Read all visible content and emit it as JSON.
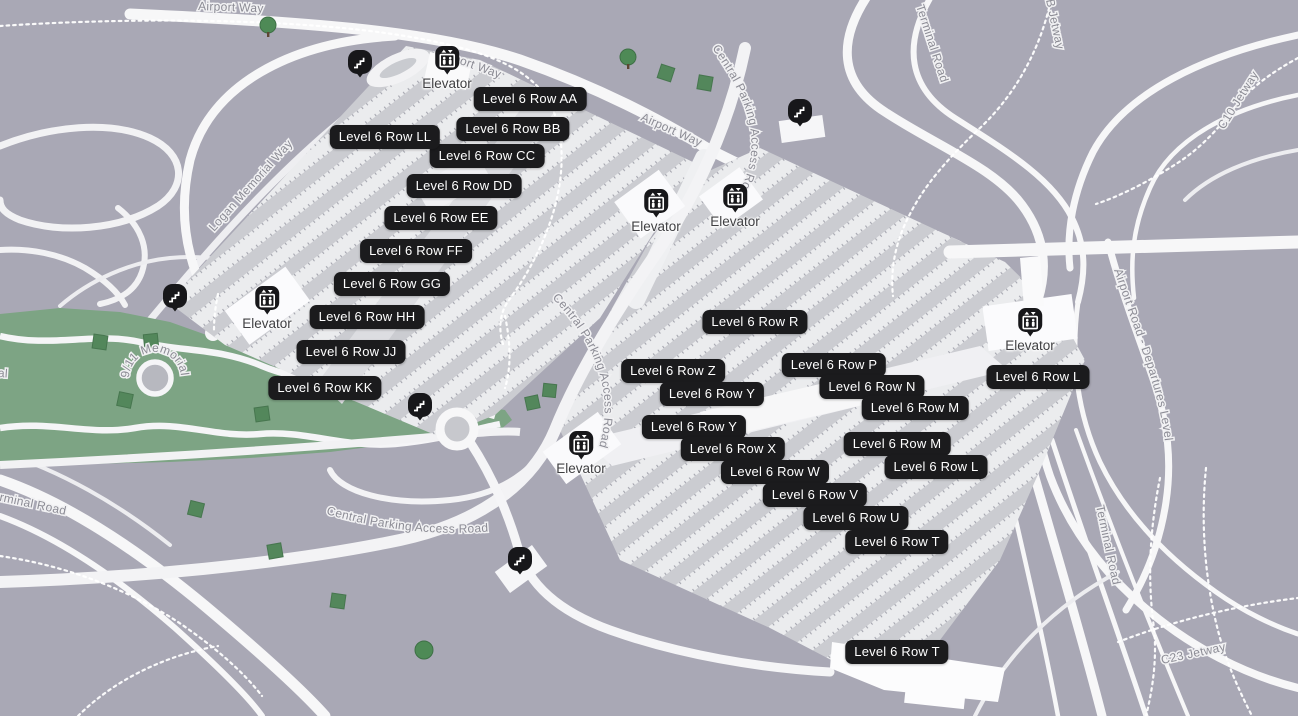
{
  "rows": [
    "Level 6 Row AA",
    "Level 6 Row BB",
    "Level 6 Row CC",
    "Level 6 Row DD",
    "Level 6 Row EE",
    "Level 6 Row FF",
    "Level 6 Row GG",
    "Level 6 Row HH",
    "Level 6 Row JJ",
    "Level 6 Row KK",
    "Level 6 Row LL",
    "Level 6 Row R",
    "Level 6 Row Z",
    "Level 6 Row P",
    "Level 6 Row Y",
    "Level 6 Row N",
    "Level 6 Row Y",
    "Level 6 Row M",
    "Level 6 Row X",
    "Level 6 Row M",
    "Level 6 Row W",
    "Level 6 Row L",
    "Level 6 Row V",
    "Level 6 Row U",
    "Level 6 Row T",
    "Level 6 Row L",
    "Level 6 Row T"
  ],
  "poi": {
    "elevator_label": "Elevator",
    "elevator_icon": "elevator-pictogram",
    "escalator_icon": "escalator-pictogram"
  },
  "roads": {
    "airport_way": "Airport Way",
    "central_parking_access_road": "Central Parking Access Road",
    "terminal_road": "Terminal Road",
    "airport_road_departures": "Airport Road - Departures Level",
    "logan_memorial_way": "Logan Memorial Way",
    "memorial_911": "9/11 Memorial",
    "memorial_fragment": "Memorial",
    "b_jetway": "B Jetway",
    "c10_jetway": "C10 Jetway",
    "c23_jetway": "C23 Jetway"
  },
  "colors": {
    "background": "#a9a8b5",
    "park": "#7da484",
    "road": "#f7f7f8",
    "garage_aisle": "#cbccd1",
    "garage_row": "#ebecee",
    "label_bg": "#1b1b1d",
    "label_text": "#ffffff",
    "road_label": "#8c8c95",
    "tree": "#4e8a56"
  }
}
